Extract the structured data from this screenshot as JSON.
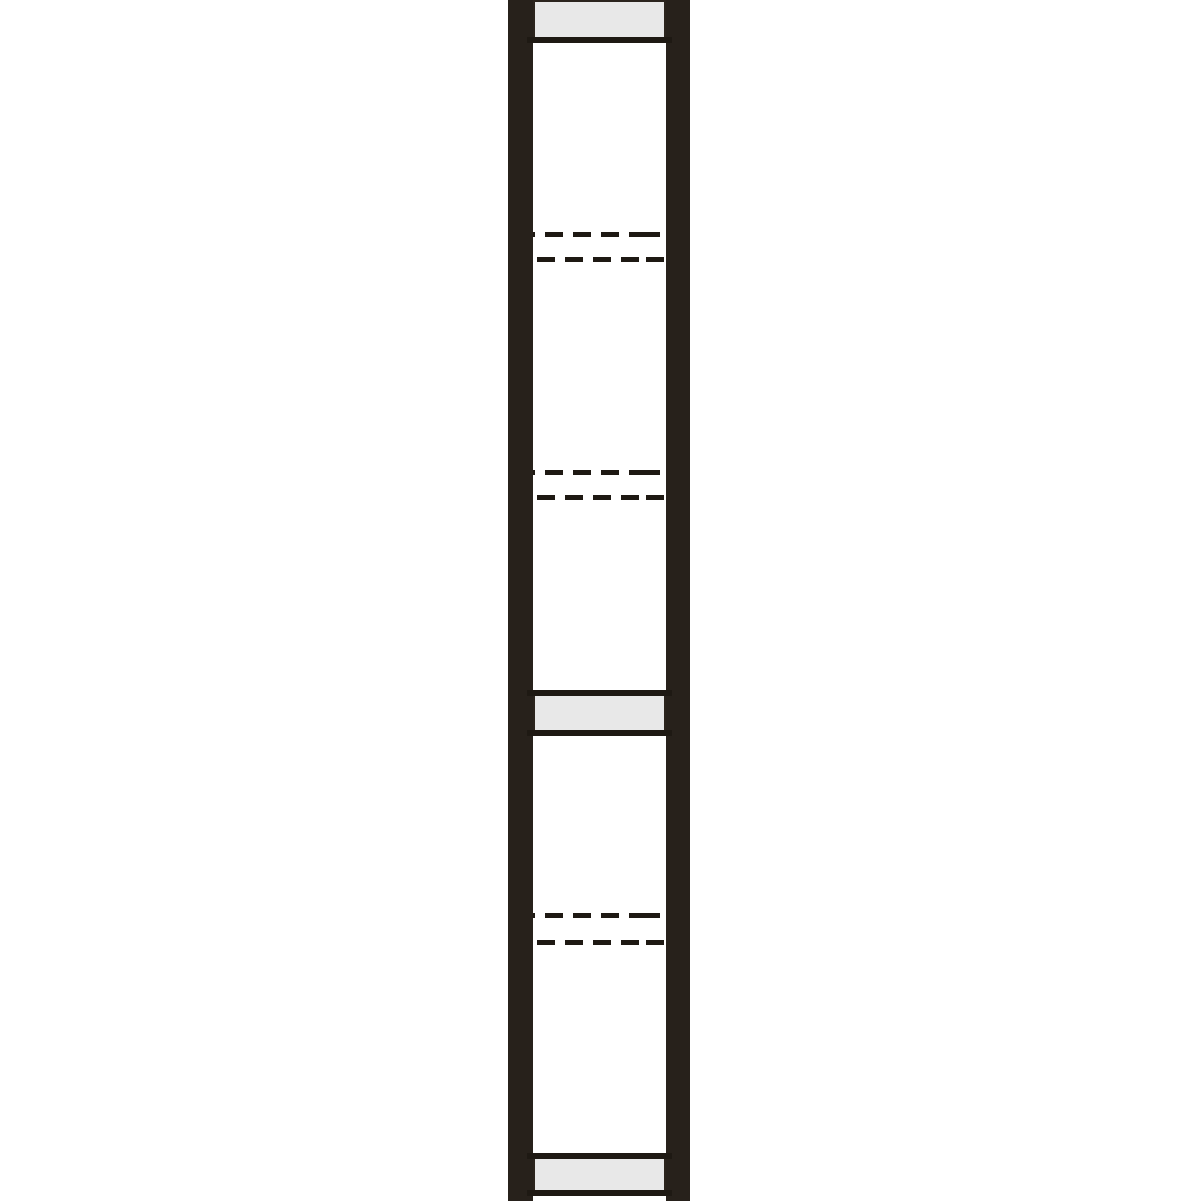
{
  "diagram": {
    "kind": "technical line drawing of a vertical frame member (two dark stiles with cross panels and hidden-edge dashed markers)",
    "canvas": {
      "width": 1201,
      "height": 1201
    },
    "colors": {
      "background": "#ffffff",
      "member": "#27211b",
      "line": "#1e1913",
      "panel_fill": "#e8e8e8",
      "panel_border": "#2b241d"
    },
    "stiles": {
      "left": {
        "x": 508,
        "width": 25
      },
      "right": {
        "x": 666,
        "width": 24
      }
    },
    "interior": {
      "x": 533,
      "width": 133
    },
    "panels": [
      {
        "name": "top-end-panel",
        "y": 0,
        "height": 37
      },
      {
        "name": "mid-rail-panel",
        "y": 696,
        "height": 34
      },
      {
        "name": "bottom-end-panel",
        "y": 1159,
        "height": 31
      }
    ],
    "solid_lines": [
      {
        "name": "top-panel-bottom-edge",
        "y": 37
      },
      {
        "name": "mid-panel-top-edge",
        "y": 690
      },
      {
        "name": "mid-panel-bottom-edge",
        "y": 730
      },
      {
        "name": "bottom-panel-top-edge",
        "y": 1153
      },
      {
        "name": "bottom-panel-bottom-edge",
        "y": 1190
      }
    ],
    "dashed_pairs": [
      {
        "name": "upper-hidden-edges",
        "y_top": 232,
        "y_bottom": 257
      },
      {
        "name": "middle-hidden-edges",
        "y_top": 470,
        "y_bottom": 495
      },
      {
        "name": "lower-hidden-edges",
        "y_top": 913,
        "y_bottom": 940
      }
    ],
    "dash_pattern": {
      "dash": 18,
      "gap": 10,
      "thickness": 5
    }
  }
}
